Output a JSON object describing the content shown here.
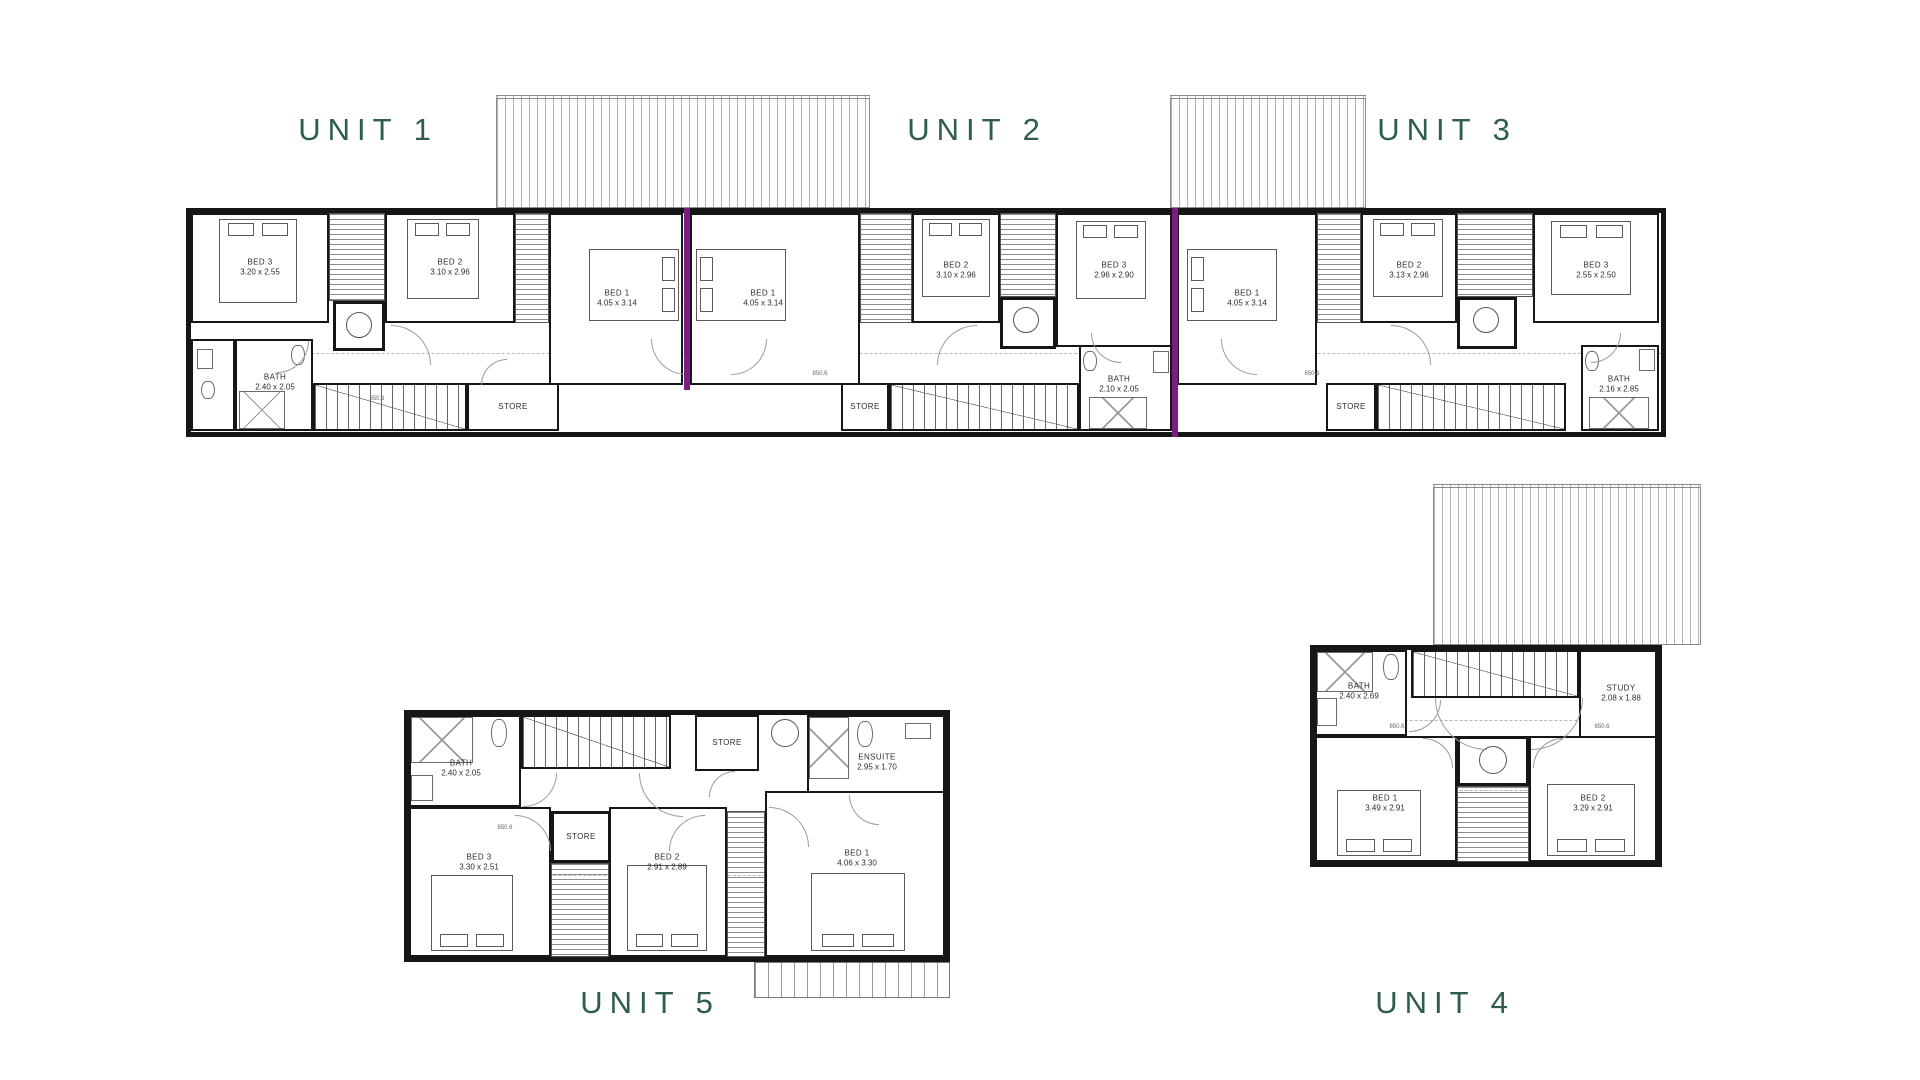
{
  "sheet": {
    "type": "first-floor plan, 5-unit townhouse development",
    "background_color": "#ffffff",
    "wall_color": "#161616",
    "party_wall_color": "#7c1e7e",
    "unit_label_color": "#2e5d4e"
  },
  "unit_labels": {
    "unit1": "UNIT 1",
    "unit2": "UNIT 2",
    "unit3": "UNIT 3",
    "unit4": "UNIT 4",
    "unit5": "UNIT 5"
  },
  "unit1": {
    "bed3": {
      "name": "BED 3",
      "dim": "3.20 x 2.55"
    },
    "bed2": {
      "name": "BED 2",
      "dim": "3.10 x 2.96"
    },
    "bed1": {
      "name": "BED 1",
      "dim": "4.05 x 3.14"
    },
    "bath": {
      "name": "BATH",
      "dim": "2.40 x 2.05"
    },
    "store": {
      "name": "STORE"
    }
  },
  "unit2": {
    "bed1": {
      "name": "BED 1",
      "dim": "4.05 x 3.14"
    },
    "bed2": {
      "name": "BED 2",
      "dim": "3.10 x 2.96"
    },
    "bed3": {
      "name": "BED 3",
      "dim": "2.96 x 2.90"
    },
    "bath": {
      "name": "BATH",
      "dim": "2.10 x 2.05"
    },
    "store": {
      "name": "STORE"
    }
  },
  "unit3": {
    "bed1": {
      "name": "BED 1",
      "dim": "4.05 x 3.14"
    },
    "bed2": {
      "name": "BED 2",
      "dim": "3.13 x 2.96"
    },
    "bed3": {
      "name": "BED 3",
      "dim": "2.55 x 2.50"
    },
    "bath": {
      "name": "BATH",
      "dim": "2.16 x 2.85"
    },
    "store": {
      "name": "STORE"
    }
  },
  "unit5": {
    "bath": {
      "name": "BATH",
      "dim": "2.40 x 2.05"
    },
    "ensuite": {
      "name": "ENSUITE",
      "dim": "2.95 x 1.70"
    },
    "store_top": {
      "name": "STORE"
    },
    "store_mid": {
      "name": "STORE"
    },
    "bed3": {
      "name": "BED 3",
      "dim": "3.30 x 2.51"
    },
    "bed2": {
      "name": "BED 2",
      "dim": "2.91 x 2.89"
    },
    "bed1": {
      "name": "BED 1",
      "dim": "4.06 x 3.30"
    }
  },
  "unit4": {
    "bath": {
      "name": "BATH",
      "dim": "2.40 x 2.69"
    },
    "study": {
      "name": "STUDY",
      "dim": "2.08 x 1.88"
    },
    "bed1": {
      "name": "BED 1",
      "dim": "3.49 x 2.91"
    },
    "bed2": {
      "name": "BED 2",
      "dim": "3.29 x 2.91"
    }
  },
  "micro": {
    "door_dim": "850.6"
  }
}
